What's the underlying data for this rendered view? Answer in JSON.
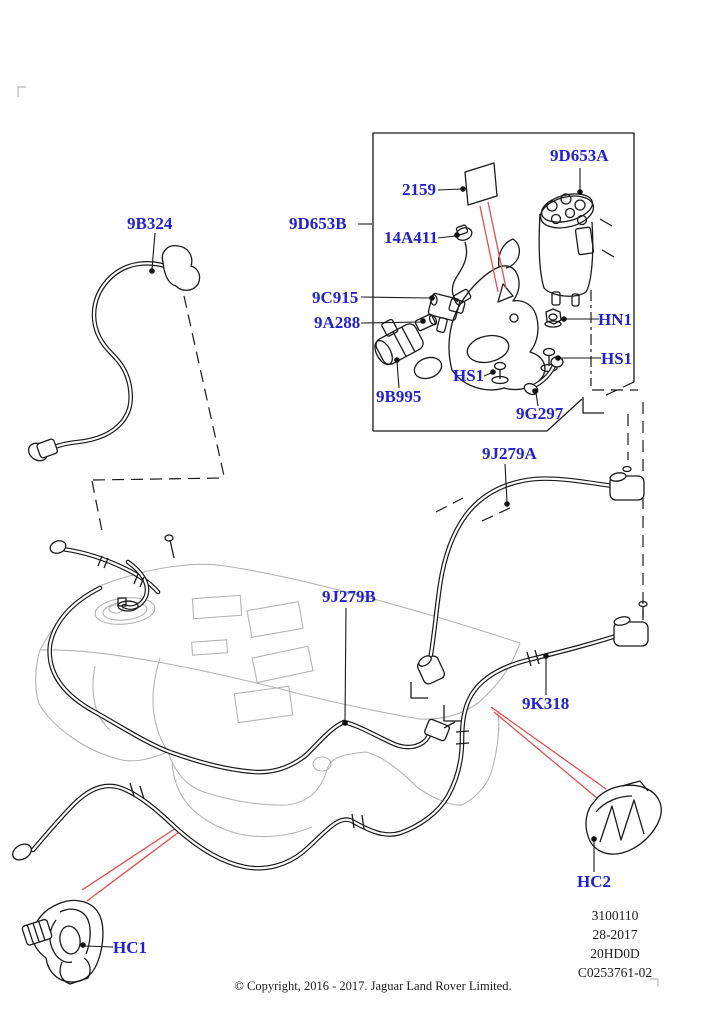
{
  "colors": {
    "label_blue": "#2222cc",
    "line_black": "#1a1a1a",
    "tank_gray": "#b4b4b4",
    "leader_red": "#e84d4d",
    "background": "#ffffff"
  },
  "callouts": [
    {
      "id": "9B324",
      "text": "9B324"
    },
    {
      "id": "9D653B",
      "text": "9D653B"
    },
    {
      "id": "2159",
      "text": "2159"
    },
    {
      "id": "14A411",
      "text": "14A411"
    },
    {
      "id": "9C915",
      "text": "9C915"
    },
    {
      "id": "9A288",
      "text": "9A288"
    },
    {
      "id": "9B995",
      "text": "9B995"
    },
    {
      "id": "HS1-left",
      "text": "HS1"
    },
    {
      "id": "9G297",
      "text": "9G297"
    },
    {
      "id": "9D653A",
      "text": "9D653A"
    },
    {
      "id": "HN1",
      "text": "HN1"
    },
    {
      "id": "HS1-right",
      "text": "HS1"
    },
    {
      "id": "9J279A",
      "text": "9J279A"
    },
    {
      "id": "9J279B",
      "text": "9J279B"
    },
    {
      "id": "9K318",
      "text": "9K318"
    },
    {
      "id": "HC2",
      "text": "HC2"
    },
    {
      "id": "HC1",
      "text": "HC1"
    }
  ],
  "stamp": {
    "lines": [
      "3100110",
      "28-2017",
      "20HD0D",
      "C0253761-02"
    ]
  },
  "copyright": "© Copyright, 2016 - 2017. Jaguar Land Rover Limited."
}
